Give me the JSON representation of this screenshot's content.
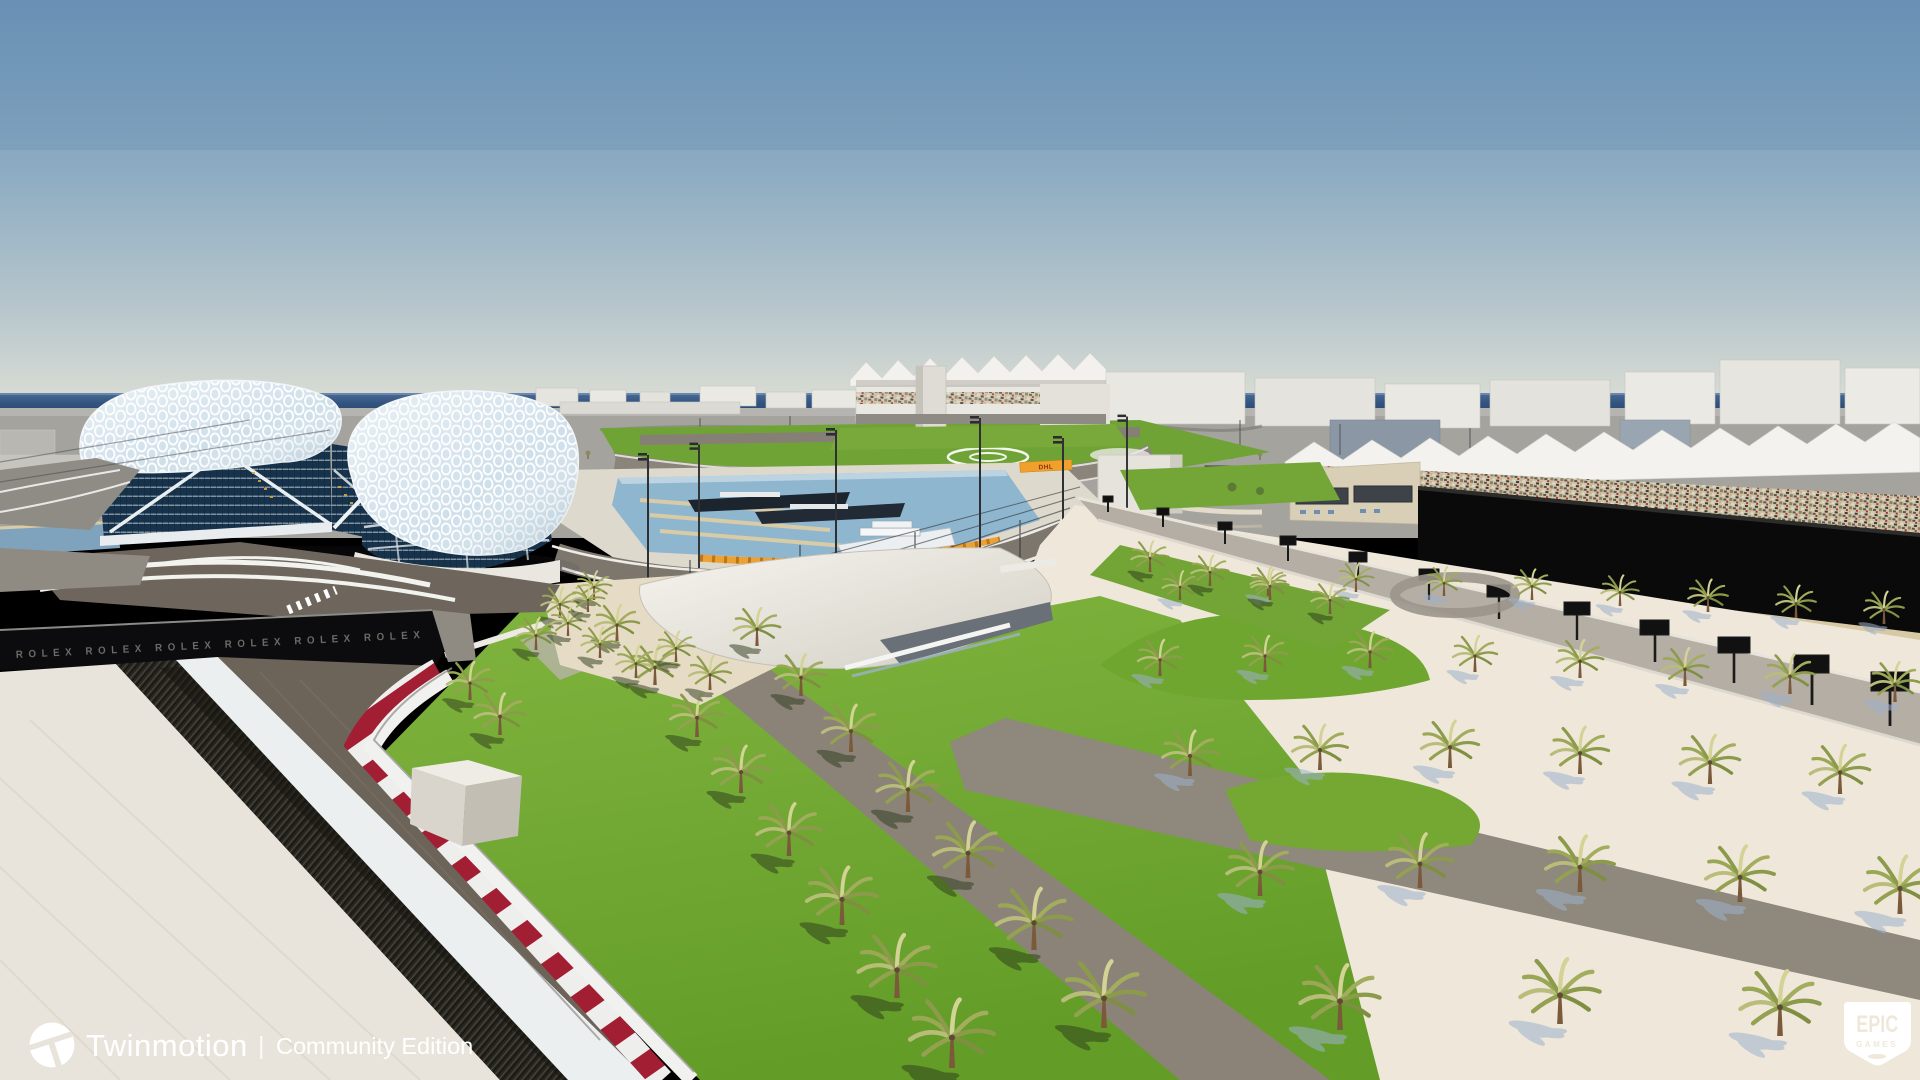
{
  "app": {
    "name": "Twinmotion render viewport"
  },
  "watermark": {
    "brand": "Twinmotion",
    "divider": "|",
    "edition": "Community Edition"
  },
  "epic_badge": {
    "line1": "EPIC",
    "line2": "GAMES"
  },
  "scene": {
    "subject": "Yas Marina Circuit style architectural 3D render with hotel gridshell canopy, marina, racetrack, palms",
    "rolex_band": "ROLEX      ROLEX      ROLEX      ROLEX      ROLEX      ROLEX",
    "dhl_banner": "DHL",
    "colors": {
      "sky_top": "#6d94b8",
      "sky_horizon": "#d9dcd4",
      "sea": "#32547e",
      "grass": "#74a733",
      "asphalt": "#6d6459",
      "curb_red": "#a21e32",
      "sand": "#efe8da",
      "canopy": "#cfdfe9",
      "glass": "#17334c",
      "black_wall": "#0a0a0a",
      "orange_curb": "#eda133"
    }
  }
}
